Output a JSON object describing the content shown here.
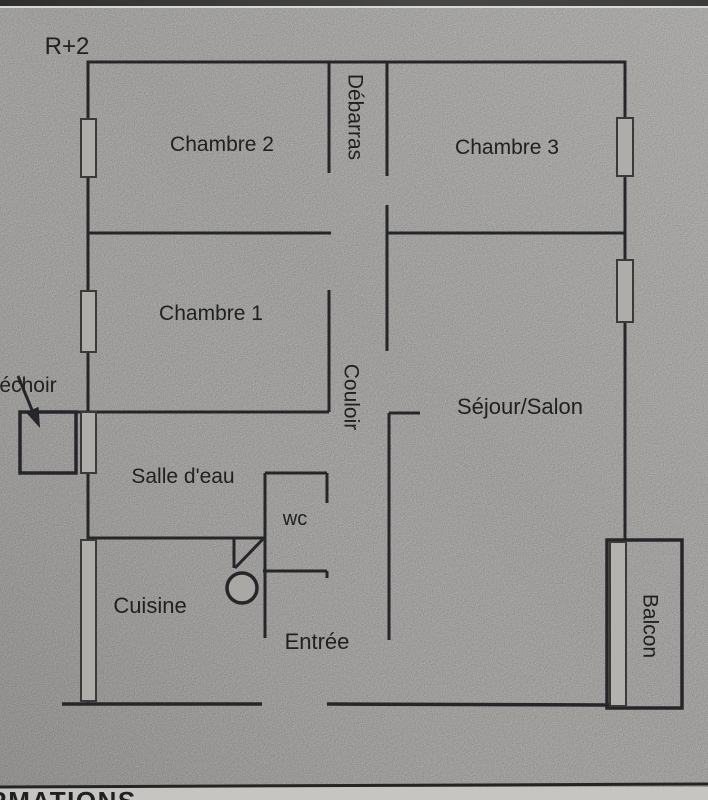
{
  "document": {
    "type": "scanned floor plan page",
    "level_label": "R+2",
    "footer_truncated_heading": "RMATIONS"
  },
  "floor_plan": {
    "rooms": {
      "chambre2": "Chambre 2",
      "debarras": "Débarras",
      "chambre3": "Chambre 3",
      "chambre1": "Chambre 1",
      "couloir": "Couloir",
      "sejour_salon": "Séjour/Salon",
      "sechoir_truncated": "échoir",
      "salle_deau": "Salle d'eau",
      "wc": "wc",
      "cuisine": "Cuisine",
      "entree": "Entrée",
      "balcon": "Balcon"
    },
    "vertical_text_rooms": [
      "Débarras",
      "Couloir",
      "Balcon"
    ],
    "symbols": [
      "window",
      "door-band",
      "door-swing",
      "door-knob-circle",
      "sechoir-arrow"
    ]
  },
  "colors": {
    "paper": "#d7d6d3",
    "wall_line": "#26262a",
    "window_fill": "#aeadaa",
    "top_scan_band": "#3a3a3a",
    "footer_band": "#c6c5c1",
    "text": "#20201f"
  }
}
